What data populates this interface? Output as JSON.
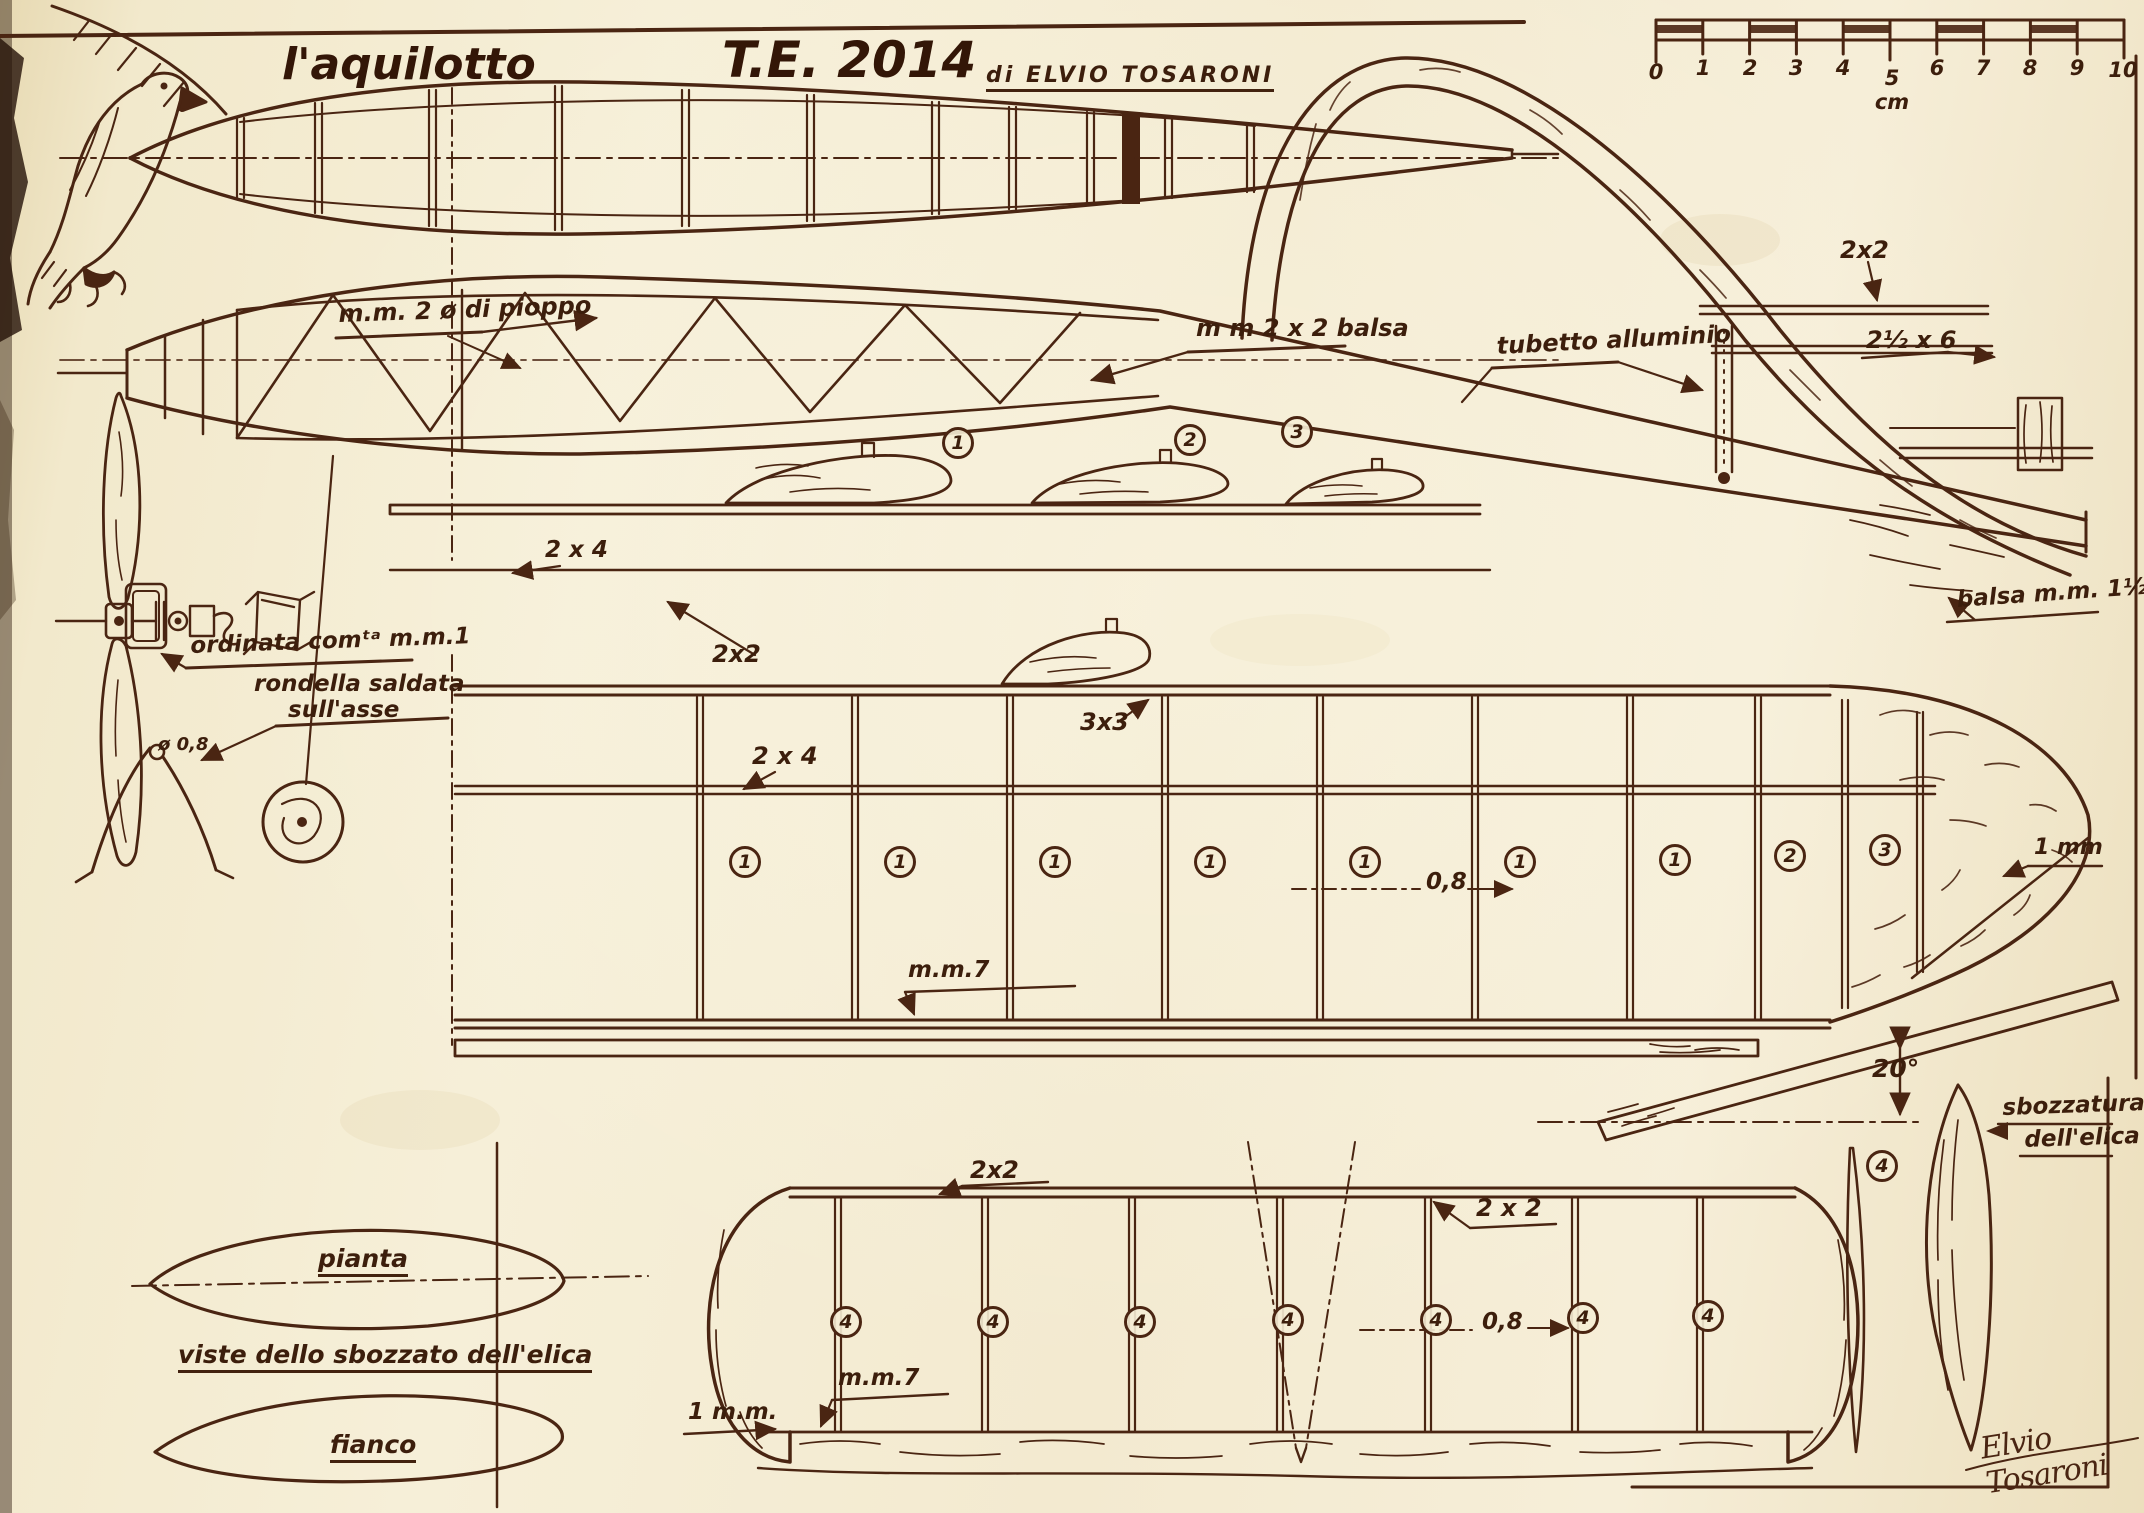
{
  "colors": {
    "paper": "#f3ead0",
    "ink": "#4a2512"
  },
  "title": {
    "name": "l'aquilotto",
    "model": "T.E. 2014",
    "byline": "di ELVIO TOSARONI"
  },
  "ruler": {
    "ticks": [
      "0",
      "1",
      "2",
      "3",
      "4",
      "5 cm",
      "6",
      "7",
      "8",
      "9",
      "10"
    ]
  },
  "sections": {
    "numbers": [
      "1",
      "2",
      "3"
    ]
  },
  "fuselage": {
    "labels": {
      "pioppo": "m.m. 2 ø di pioppo",
      "balsa": "m m  2 x 2  balsa",
      "tubetto": "tubetto alluminio",
      "fin": "2x2",
      "seat": "2½ x 6",
      "sheet": "balsa m.m. 1½"
    }
  },
  "wing": {
    "rib_numbers": [
      "1",
      "1",
      "1",
      "1",
      "1",
      "1",
      "1",
      "2",
      "3"
    ],
    "labels": {
      "longeron": "2x2",
      "le": "3x3",
      "spar_front": "2 x 4",
      "spar": "2 x 4",
      "gap": "0,8",
      "tip": "1 mm",
      "te": "m.m.7",
      "dihedral": "20°"
    }
  },
  "nose": {
    "labels": {
      "ordinata": "ordinata comᵗᵃ m.m.1",
      "rondella1": "rondella saldata",
      "rondella2": "sull'asse",
      "wire": "ø 0,8"
    }
  },
  "propeller": {
    "labels": {
      "sbozzatura1": "sbozzatura",
      "sbozzatura2": "dell'elica",
      "pianta": "pianta",
      "viste": "viste dello sbozzato dell'elica",
      "fianco": "fianco"
    }
  },
  "stab": {
    "rib_numbers": [
      "4",
      "4",
      "4",
      "4",
      "4",
      "4",
      "4",
      "4"
    ],
    "labels": {
      "le_a": "2x2",
      "le_b": "2 x 2",
      "gap": "0,8",
      "te": "m.m.7",
      "tip": "1 m.m."
    }
  },
  "signature": "Elvio Tosaroni"
}
